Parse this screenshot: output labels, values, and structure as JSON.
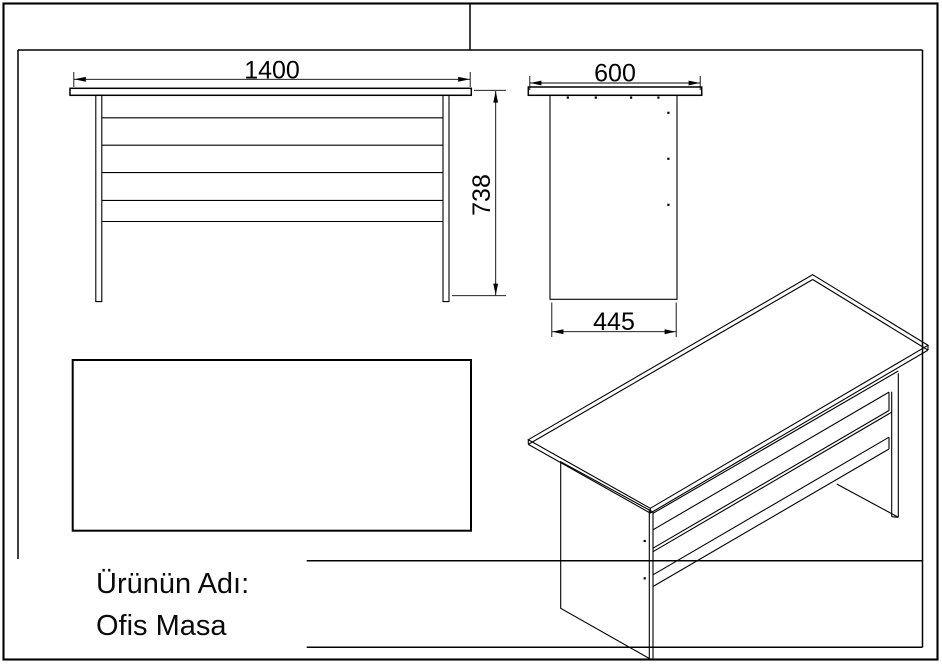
{
  "sheet": {
    "background_color": "#ffffff",
    "line_color": "#000000",
    "product": {
      "label": "Ürünün Adı:",
      "name": "Ofis Masa"
    },
    "dimensions": {
      "front_width": "1400",
      "front_height": "738",
      "side_top_width": "600",
      "side_bottom_width": "445"
    }
  }
}
